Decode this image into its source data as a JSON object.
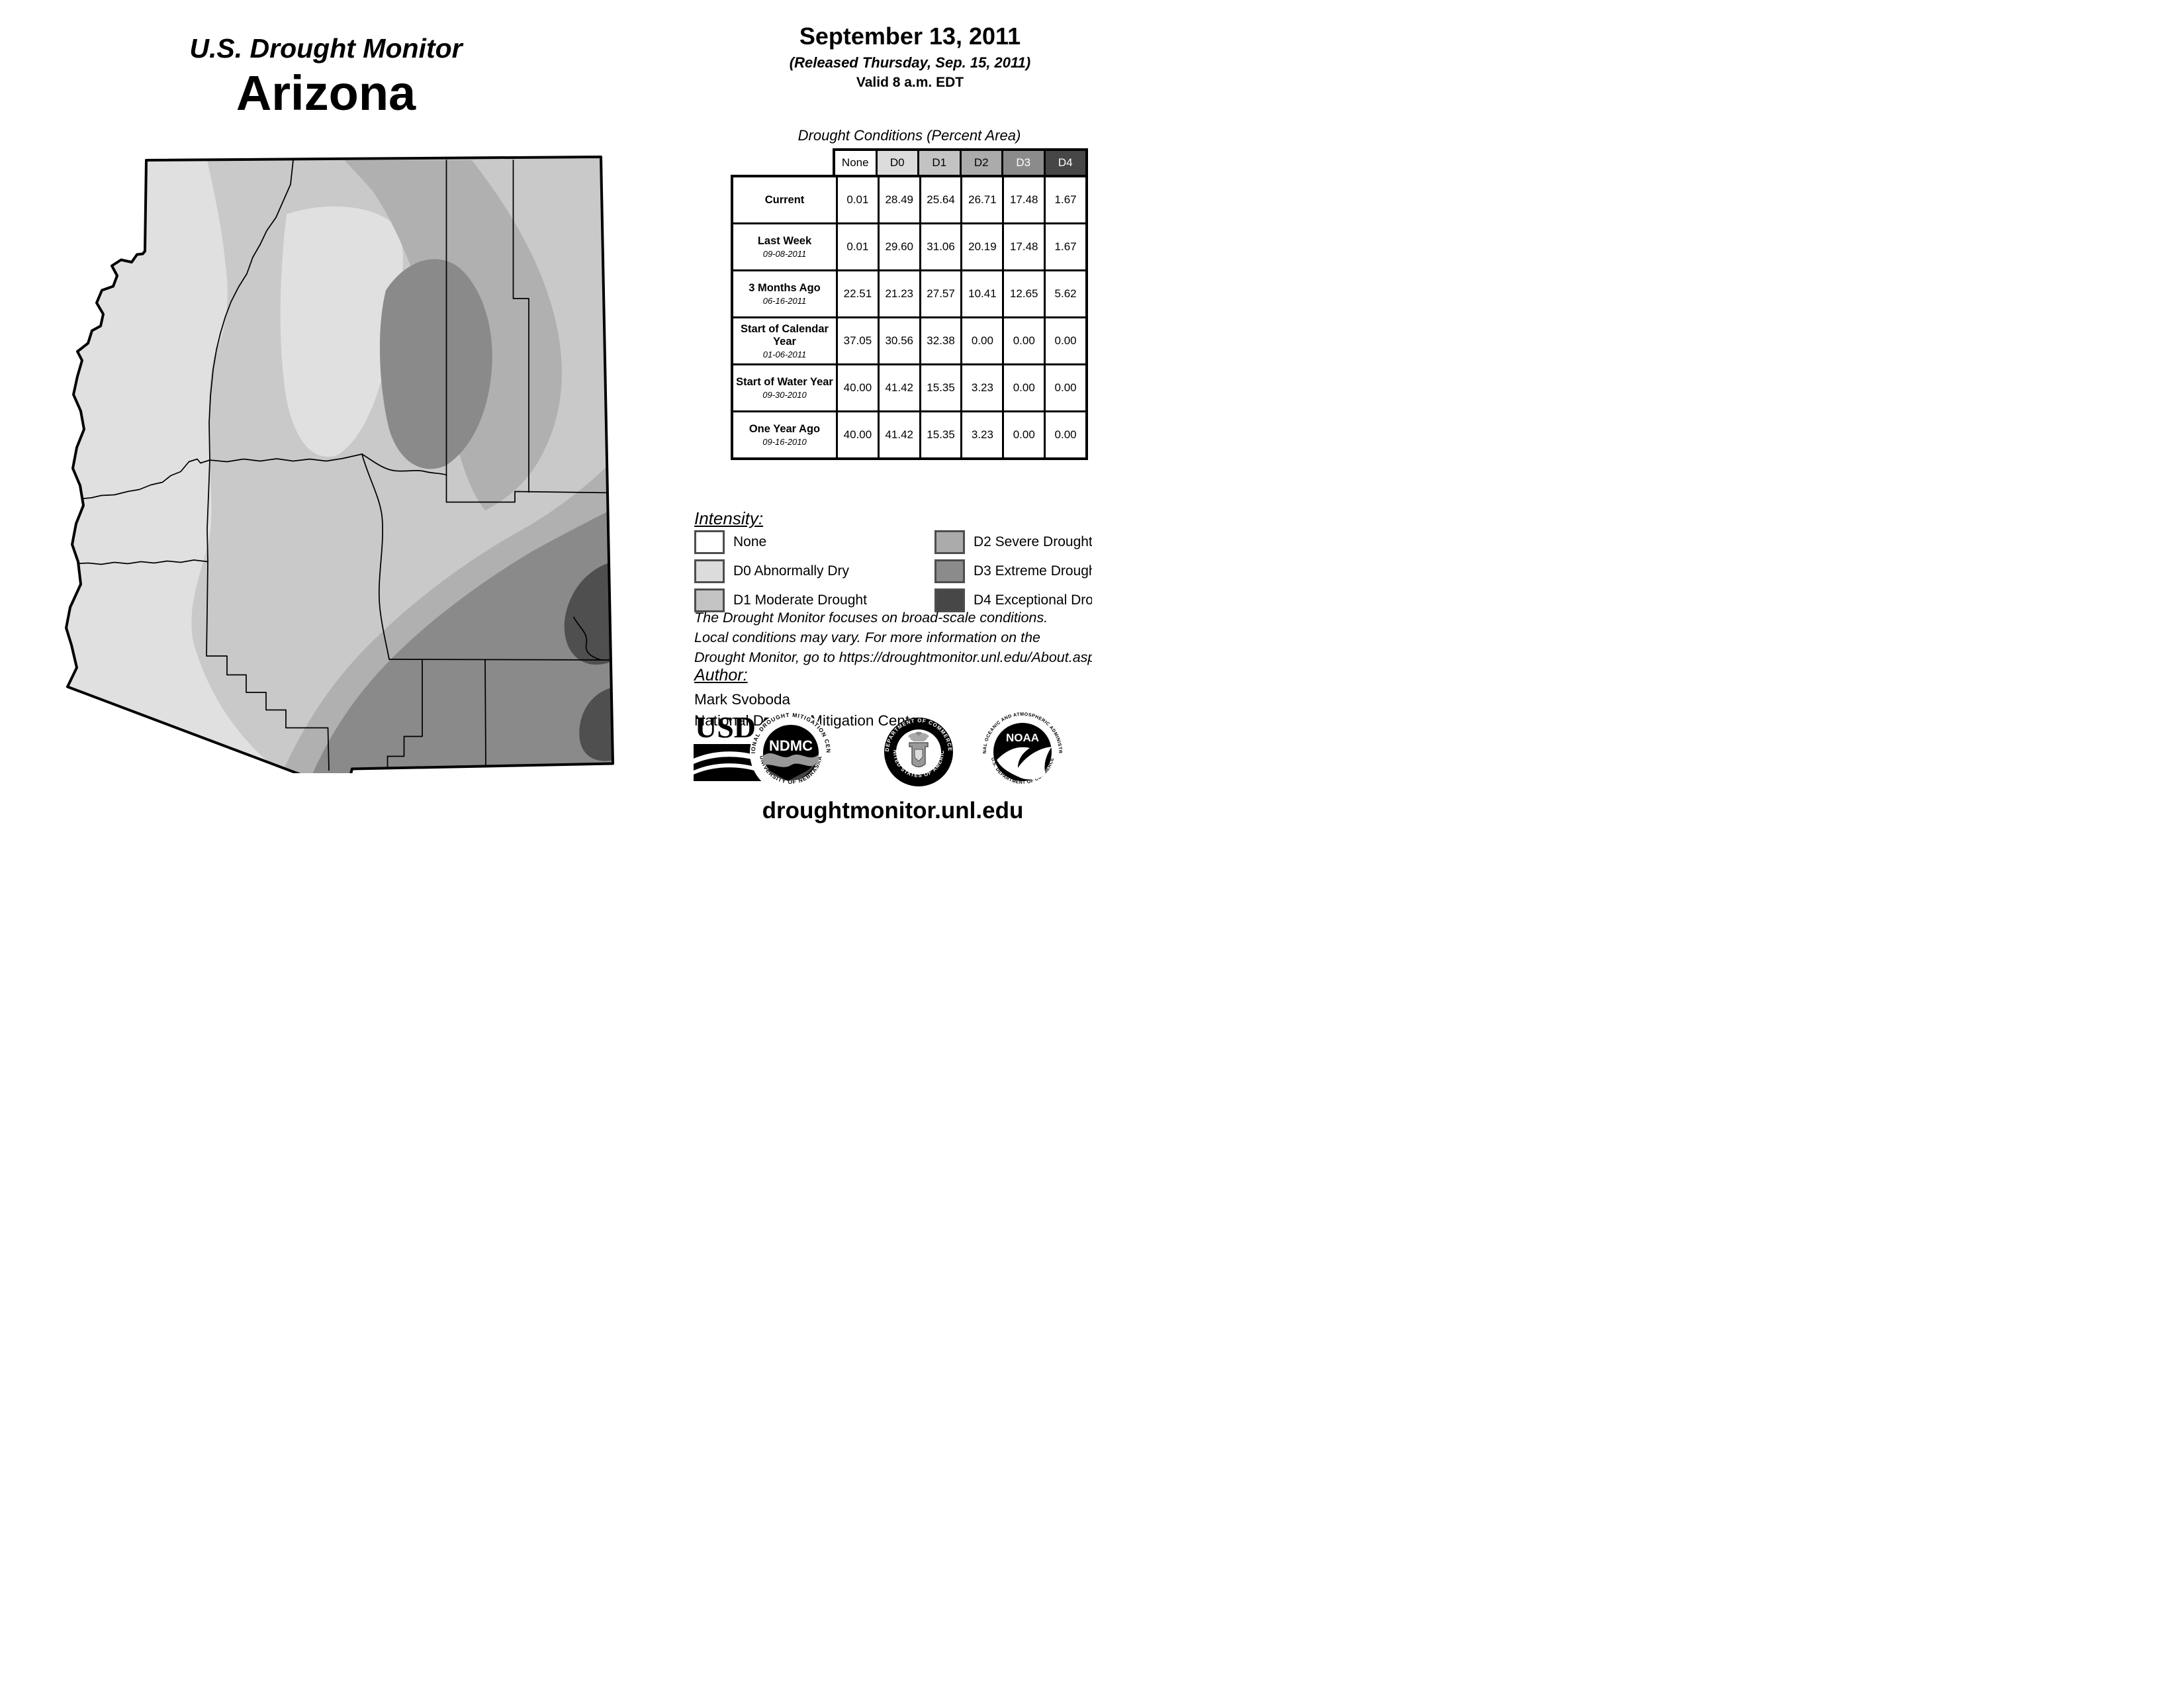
{
  "header": {
    "title": "U.S. Drought Monitor",
    "region": "Arizona"
  },
  "date_block": {
    "date": "September 13, 2011",
    "released": "(Released Thursday, Sep. 15, 2011)",
    "valid": "Valid 8 a.m. EDT"
  },
  "table": {
    "title": "Drought Conditions (Percent Area)",
    "columns": [
      "None",
      "D0",
      "D1",
      "D2",
      "D3",
      "D4"
    ],
    "header_colors": [
      "#ffffff",
      "#dcdcdc",
      "#c3c3c3",
      "#ababab",
      "#8b8b8b",
      "#474747"
    ],
    "header_text_colors": [
      "#000000",
      "#000000",
      "#000000",
      "#000000",
      "#ffffff",
      "#ffffff"
    ],
    "rows": [
      {
        "label": "Current",
        "sublabel": "",
        "values": [
          "0.01",
          "28.49",
          "25.64",
          "26.71",
          "17.48",
          "1.67"
        ]
      },
      {
        "label": "Last Week",
        "sublabel": "09-08-2011",
        "values": [
          "0.01",
          "29.60",
          "31.06",
          "20.19",
          "17.48",
          "1.67"
        ]
      },
      {
        "label": "3 Months Ago",
        "sublabel": "06-16-2011",
        "values": [
          "22.51",
          "21.23",
          "27.57",
          "10.41",
          "12.65",
          "5.62"
        ]
      },
      {
        "label": "Start of Calendar Year",
        "sublabel": "01-06-2011",
        "values": [
          "37.05",
          "30.56",
          "32.38",
          "0.00",
          "0.00",
          "0.00"
        ]
      },
      {
        "label": "Start of Water Year",
        "sublabel": "09-30-2010",
        "values": [
          "40.00",
          "41.42",
          "15.35",
          "3.23",
          "0.00",
          "0.00"
        ]
      },
      {
        "label": "One Year Ago",
        "sublabel": "09-16-2010",
        "values": [
          "40.00",
          "41.42",
          "15.35",
          "3.23",
          "0.00",
          "0.00"
        ]
      }
    ]
  },
  "legend": {
    "title": "Intensity:",
    "items": [
      {
        "label": "None",
        "color": "#ffffff"
      },
      {
        "label": "D0 Abnormally Dry",
        "color": "#dcdcdc"
      },
      {
        "label": "D1 Moderate Drought",
        "color": "#c3c3c3"
      },
      {
        "label": "D2 Severe Drought",
        "color": "#ababab"
      },
      {
        "label": "D3 Extreme Drought",
        "color": "#8b8b8b"
      },
      {
        "label": "D4 Exceptional Drought",
        "color": "#474747"
      }
    ]
  },
  "notes": {
    "line1": "The Drought Monitor focuses on broad-scale conditions.",
    "line2": "Local conditions may vary. For more information on the",
    "line3": "Drought Monitor, go to https://droughtmonitor.unl.edu/About.aspx"
  },
  "author": {
    "title": "Author:",
    "name": "Mark Svoboda",
    "org": "National Drought Mitigation Center"
  },
  "logos": {
    "usda": {
      "text": "USDA"
    },
    "ndmc": {
      "text": "NDMC",
      "ring_top": "NATIONAL DROUGHT MITIGATION CENTER",
      "ring_bottom": "UNIVERSITY OF NEBRASKA"
    },
    "doc": {
      "ring_top": "DEPARTMENT OF COMMERCE",
      "ring_bottom": "UNITED STATES OF AMERICA"
    },
    "noaa": {
      "text": "NOAA",
      "ring_top": "NATIONAL OCEANIC AND ATMOSPHERIC ADMINISTRATION",
      "ring_bottom": "U.S. DEPARTMENT OF COMMERCE"
    }
  },
  "footer": {
    "url": "droughtmonitor.unl.edu"
  },
  "map": {
    "state": "Arizona",
    "colors": {
      "none": "#ffffff",
      "d0": "#e0e0e0",
      "d1": "#c9c9c9",
      "d2": "#b0b0b0",
      "d3": "#8a8a8a",
      "d4": "#4f4f4f",
      "border": "#000000"
    }
  }
}
